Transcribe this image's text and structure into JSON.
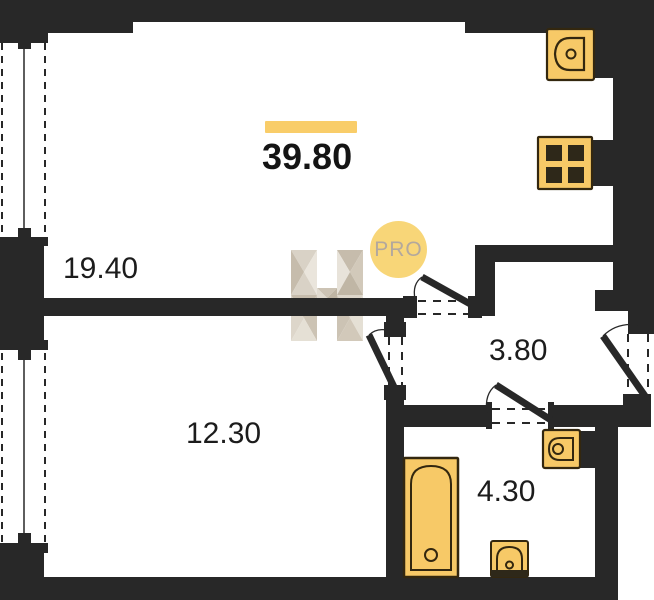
{
  "plan": {
    "total_area": "39.80",
    "rooms": [
      {
        "name": "living-kitchen",
        "area": "19.40"
      },
      {
        "name": "bedroom",
        "area": "12.30"
      },
      {
        "name": "hallway",
        "area": "3.80"
      },
      {
        "name": "bathroom",
        "area": "4.30"
      }
    ],
    "badge": {
      "label": "PRO"
    },
    "fixtures": [
      "kitchen-sink-icon",
      "stove-icon",
      "bathroom-sink-icon",
      "toilet-icon",
      "bathtub-icon"
    ],
    "watermark": "h-logo-icon",
    "colors": {
      "wall": "#282828",
      "fixture": "#F7C967",
      "fixture_outline": "#33270F",
      "fixture_dark": "#2E2819",
      "accent_bar": "#F9CD69",
      "badge_fill": "#F8D678",
      "badge_text": "#B3A89D",
      "label_text": "#1C1C1C"
    }
  }
}
